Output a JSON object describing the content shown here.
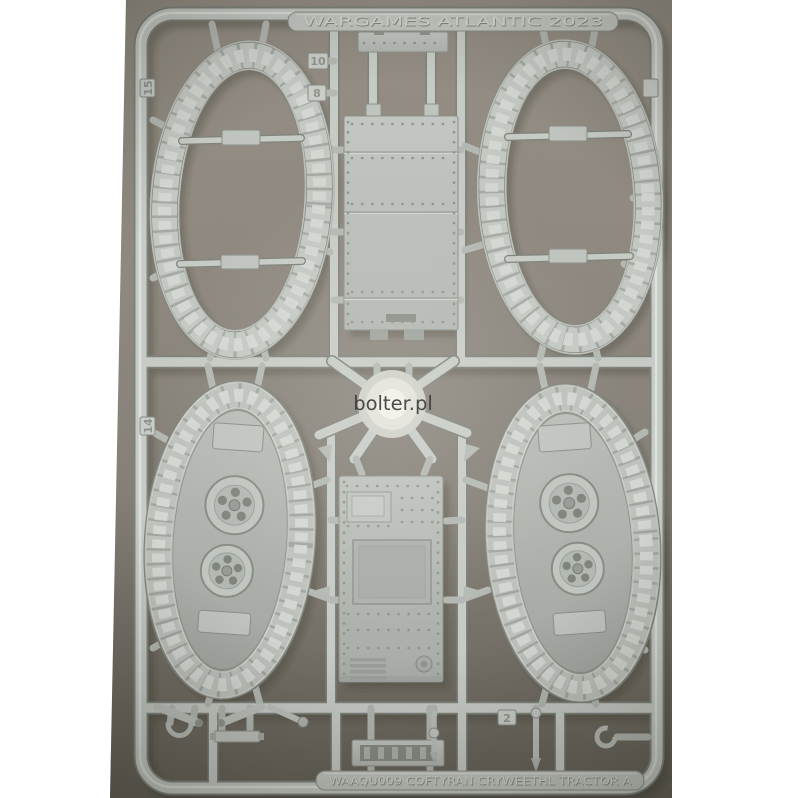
{
  "image": {
    "type": "photograph",
    "subject": "Light grey plastic model kit sprue with tank track rings, hull plates and road wheels, photographed on a grey surface"
  },
  "watermark": {
    "text": "bolter.pl"
  },
  "sprue": {
    "brand_text": "WARGAMES ATLANTIC 2023",
    "product_text": "WAAQU009 COFTYRAN CRYWEETHL TRACTOR A",
    "tags": {
      "left_upper": "15",
      "left_lower": "14",
      "top_runner_upper": "10",
      "top_runner_lower": "8",
      "bottom_right": "2",
      "right_upper": ""
    }
  },
  "colors": {
    "surface": "#8b857c",
    "plastic": "#c6cac5",
    "margin": "#ffffff",
    "watermark": "#3a3a3a"
  }
}
